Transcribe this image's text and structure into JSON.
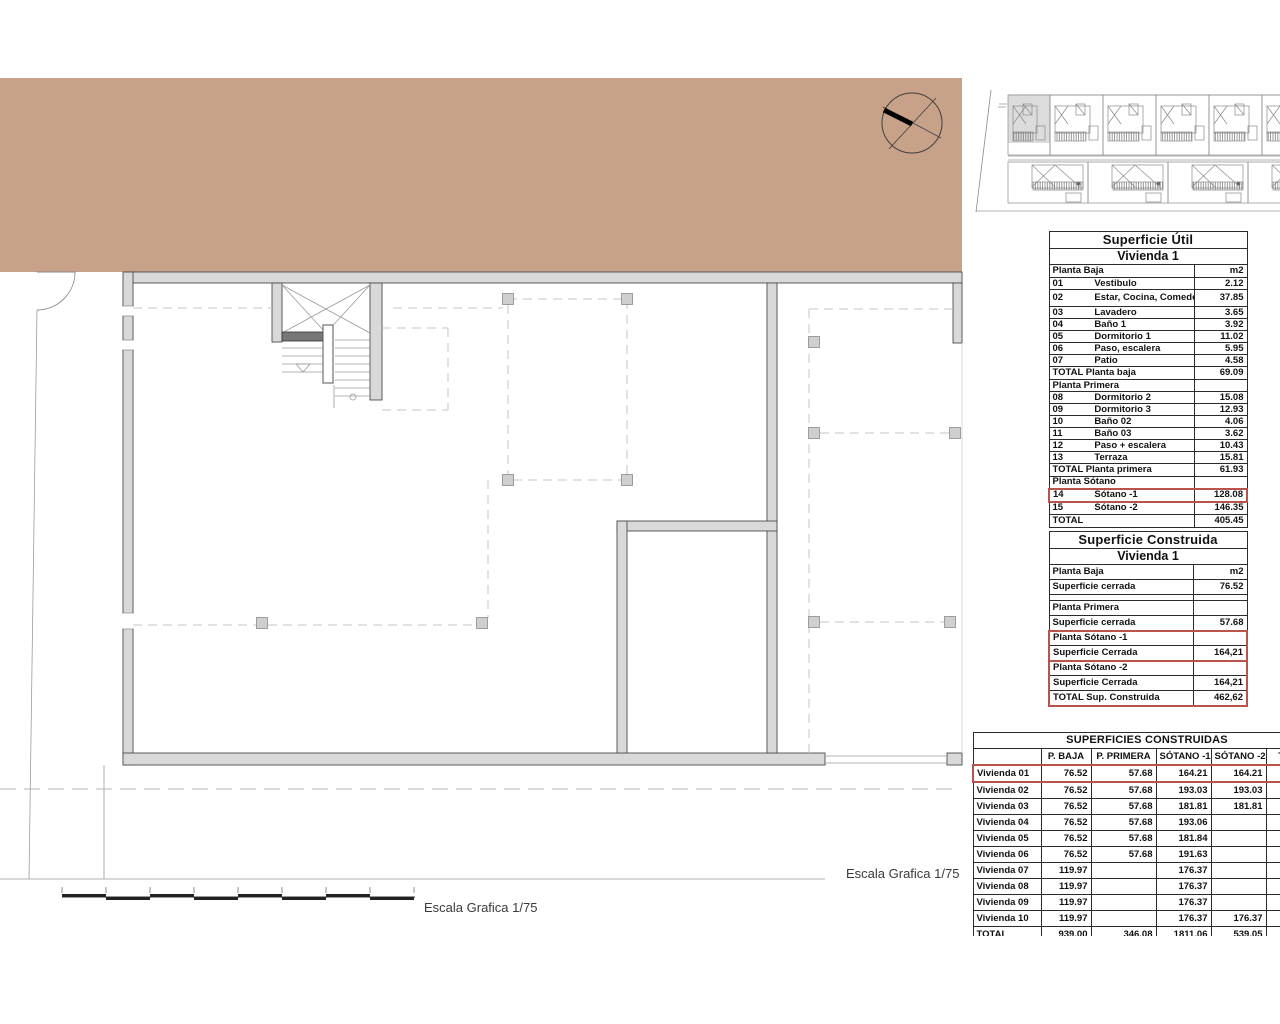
{
  "colors": {
    "terrain": "#c7a289",
    "wall_fill": "#d9d9d9",
    "wall_stroke": "#4c4c4c",
    "highlight_red": "#b9544c",
    "dashed_line": "#c6c6c6"
  },
  "scale_labels": {
    "bottom": "Escala Grafica 1/75",
    "right": "Escala Grafica 1/75"
  },
  "tables": {
    "util": {
      "title": "Superficie Útil",
      "subtitle": "Vivienda 1",
      "unit_header": {
        "label": "Planta Baja",
        "unit": "m2"
      },
      "rows": [
        {
          "num": "01",
          "name": "Vestibulo",
          "value": "2.12"
        },
        {
          "num": "02",
          "name": "Estar, Cocina, Comedor",
          "value": "37.85",
          "tall": true
        },
        {
          "num": "03",
          "name": "Lavadero",
          "value": "3.65"
        },
        {
          "num": "04",
          "name": "Baño 1",
          "value": "3.92"
        },
        {
          "num": "05",
          "name": "Dormitorio 1",
          "value": "11.02"
        },
        {
          "num": "06",
          "name": "Paso, escalera",
          "value": "5.95"
        },
        {
          "num": "07",
          "name": "Patio",
          "value": "4.58"
        },
        {
          "num": "",
          "name": "TOTAL Planta baja",
          "value": "69.09",
          "kind": "total"
        },
        {
          "num": "",
          "name": "Planta Primera",
          "value": "",
          "kind": "section"
        },
        {
          "num": "08",
          "name": "Dormitorio 2",
          "value": "15.08"
        },
        {
          "num": "09",
          "name": "Dormitorio 3",
          "value": "12.93"
        },
        {
          "num": "10",
          "name": "Baño 02",
          "value": "4.06"
        },
        {
          "num": "11",
          "name": "Baño 03",
          "value": "3.62"
        },
        {
          "num": "12",
          "name": "Paso + escalera",
          "value": "10.43"
        },
        {
          "num": "13",
          "name": "Terraza",
          "value": "15.81"
        },
        {
          "num": "",
          "name": "TOTAL Planta primera",
          "value": "61.93",
          "kind": "total"
        },
        {
          "num": "",
          "name": "Planta Sótano",
          "value": "",
          "kind": "section"
        },
        {
          "num": "14",
          "name": "Sótano -1",
          "value": "128.08",
          "highlight": true,
          "big": true
        },
        {
          "num": "15",
          "name": "Sótano -2",
          "value": "146.35",
          "big": true
        },
        {
          "num": "",
          "name": "TOTAL",
          "value": "405.45",
          "kind": "total"
        }
      ]
    },
    "construida": {
      "title": "Superficie Construida",
      "subtitle": "Vivienda 1",
      "rows": [
        {
          "name": "Planta Baja",
          "value": "m2"
        },
        {
          "name": "Superficie cerrada",
          "value": "76.52"
        },
        {
          "name": "",
          "value": "",
          "kind": "spacer"
        },
        {
          "name": "Planta Primera",
          "value": ""
        },
        {
          "name": "Superficie cerrada",
          "value": "57.68"
        },
        {
          "name": "Planta Sótano -1",
          "value": "",
          "group": "red1",
          "gpos": "top"
        },
        {
          "name": "Superficie Cerrada",
          "value": "164,21",
          "group": "red1",
          "gpos": "bottom"
        },
        {
          "name": "Planta Sótano -2",
          "value": "",
          "group": "red2",
          "gpos": "top"
        },
        {
          "name": "Superficie Cerrada",
          "value": "164,21",
          "group": "red2",
          "gpos": "mid"
        },
        {
          "name": "TOTAL Sup. Construida",
          "value": "462,62",
          "group": "red2",
          "gpos": "bottom"
        }
      ]
    },
    "resumen": {
      "title": "SUPERFICIES CONSTRUIDAS",
      "columns": [
        "",
        "P. BAJA",
        "P. PRIMERA",
        "SÓTANO -1",
        "SÓTANO -2",
        "TOTAL"
      ],
      "rows": [
        {
          "label": "Vivienda 01",
          "values": [
            "76.52",
            "57.68",
            "164.21",
            "164.21",
            ""
          ],
          "highlight": true
        },
        {
          "label": "Vivienda 02",
          "values": [
            "76.52",
            "57.68",
            "193.03",
            "193.03",
            ""
          ]
        },
        {
          "label": "Vivienda 03",
          "values": [
            "76.52",
            "57.68",
            "181.81",
            "181.81",
            ""
          ]
        },
        {
          "label": "Vivienda 04",
          "values": [
            "76.52",
            "57.68",
            "193.06",
            "",
            ""
          ]
        },
        {
          "label": "Vivienda 05",
          "values": [
            "76.52",
            "57.68",
            "181.84",
            "",
            ""
          ]
        },
        {
          "label": "Vivienda 06",
          "values": [
            "76.52",
            "57.68",
            "191.63",
            "",
            ""
          ]
        },
        {
          "label": "Vivienda 07",
          "values": [
            "119.97",
            "",
            "176.37",
            "",
            ""
          ]
        },
        {
          "label": "Vivienda 08",
          "values": [
            "119.97",
            "",
            "176.37",
            "",
            ""
          ]
        },
        {
          "label": "Vivienda 09",
          "values": [
            "119.97",
            "",
            "176.37",
            "",
            ""
          ]
        },
        {
          "label": "Vivienda 10",
          "values": [
            "119.97",
            "",
            "176.37",
            "176.37",
            ""
          ]
        },
        {
          "label": "TOTAL",
          "values": [
            "939.00",
            "346.08",
            "1811.06",
            "539.05",
            ""
          ]
        }
      ]
    }
  }
}
